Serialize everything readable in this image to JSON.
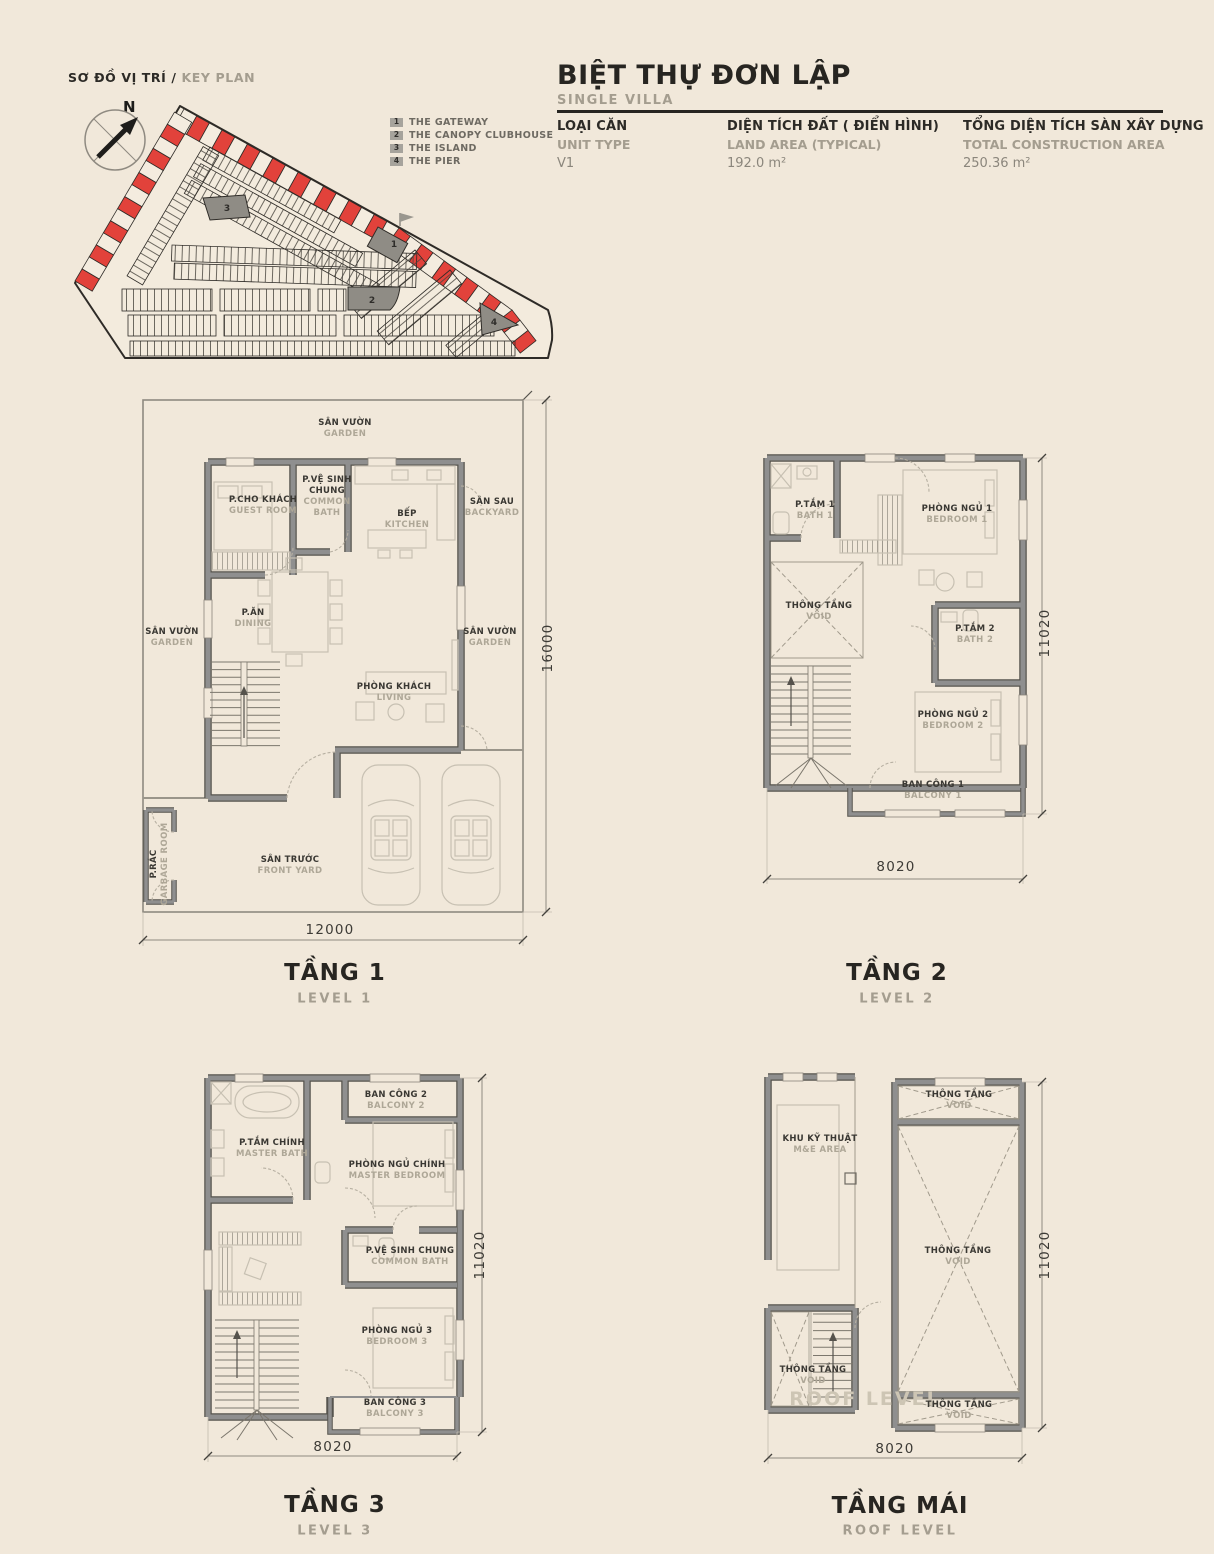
{
  "colors": {
    "background": "#F1E8DA",
    "accent_red": "#E2423B",
    "wall_gray": "#8A8A8A",
    "text_dark": "#2C2A26",
    "text_muted": "#A49D8F"
  },
  "key_plan": {
    "title_vi": "SƠ ĐỒ VỊ TRÍ /",
    "title_en": " KEY PLAN",
    "north_label": "N",
    "legend": [
      {
        "num": "1",
        "label": "THE GATEWAY"
      },
      {
        "num": "2",
        "label": "THE CANOPY CLUBHOUSE"
      },
      {
        "num": "3",
        "label": "THE ISLAND"
      },
      {
        "num": "4",
        "label": "THE PIER"
      }
    ],
    "markers": {
      "m1": "1",
      "m2": "2",
      "m3": "3",
      "m4": "4"
    }
  },
  "header": {
    "title": "BIỆT THỰ ĐƠN LẬP",
    "subtitle": "SINGLE VILLA",
    "specs": [
      {
        "label_vi": "LOẠI CĂN",
        "label_en": "UNIT TYPE",
        "value": "V1"
      },
      {
        "label_vi": "DIỆN TÍCH ĐẤT ( ĐIỂN HÌNH)",
        "label_en": "LAND AREA (TYPICAL)",
        "value": "192.0 m²"
      },
      {
        "label_vi": "TỔNG DIỆN TÍCH SÀN XÂY DỰNG",
        "label_en": "TOTAL CONSTRUCTION AREA",
        "value": "250.36 m²"
      }
    ]
  },
  "levels": {
    "l1": {
      "title": "TẦNG 1",
      "subtitle": "LEVEL 1",
      "dim_width": "12000",
      "dim_height": "16000",
      "rooms": {
        "garden_top": {
          "vi": "SÂN VƯỜN",
          "en": "GARDEN"
        },
        "backyard": {
          "vi": "SÂN SAU",
          "en": "BACKYARD"
        },
        "guest_room": {
          "vi": "P.CHO KHÁCH",
          "en": "GUEST ROOM"
        },
        "common_bath": {
          "vi": "P.VỆ SINH CHUNG",
          "en": "COMMON BATH"
        },
        "kitchen": {
          "vi": "BẾP",
          "en": "KITCHEN"
        },
        "garden_left": {
          "vi": "SÂN VƯỜN",
          "en": "GARDEN"
        },
        "dining": {
          "vi": "P.ĂN",
          "en": "DINING"
        },
        "garden_right": {
          "vi": "SÂN VƯỜN",
          "en": "GARDEN"
        },
        "living": {
          "vi": "PHÒNG KHÁCH",
          "en": "LIVING"
        },
        "front_yard": {
          "vi": "SÂN TRƯỚC",
          "en": "FRONT YARD"
        },
        "garbage": {
          "vi": "P.RÁC",
          "en": "GARBAGE ROOM"
        }
      }
    },
    "l2": {
      "title": "TẦNG 2",
      "subtitle": "LEVEL 2",
      "dim_width": "8020",
      "dim_height": "11020",
      "rooms": {
        "bath1": {
          "vi": "P.TẮM 1",
          "en": "BATH 1"
        },
        "bedroom1": {
          "vi": "PHÒNG NGỦ 1",
          "en": "BEDROOM 1"
        },
        "void": {
          "vi": "THÔNG TẦNG",
          "en": "VOID"
        },
        "bath2": {
          "vi": "P.TẮM 2",
          "en": "BATH 2"
        },
        "bedroom2": {
          "vi": "PHÒNG NGỦ 2",
          "en": "BEDROOM 2"
        },
        "balcony1": {
          "vi": "BAN CÔNG 1",
          "en": "BALCONY 1"
        }
      }
    },
    "l3": {
      "title": "TẦNG 3",
      "subtitle": "LEVEL 3",
      "dim_width": "8020",
      "dim_height": "11020",
      "rooms": {
        "balcony2": {
          "vi": "BAN CÔNG 2",
          "en": "BALCONY 2"
        },
        "master_bath": {
          "vi": "P.TẮM CHÍNH",
          "en": "MASTER BATH"
        },
        "master_bedroom": {
          "vi": "PHÒNG NGỦ CHÍNH",
          "en": "MASTER BEDROOM"
        },
        "common_bath": {
          "vi": "P.VỆ SINH CHUNG",
          "en": "COMMON BATH"
        },
        "bedroom3": {
          "vi": "PHÒNG NGỦ 3",
          "en": "BEDROOM 3"
        },
        "balcony3": {
          "vi": "BAN CÔNG 3",
          "en": "BALCONY 3"
        }
      }
    },
    "roof": {
      "title": "TẦNG MÁI",
      "subtitle": "ROOF LEVEL",
      "dim_width": "8020",
      "dim_height": "11020",
      "watermark": "ROOF LEVEL",
      "rooms": {
        "void_top": {
          "vi": "THÔNG TẦNG",
          "en": "VOID"
        },
        "me_area": {
          "vi": "KHU KỸ THUẬT",
          "en": "M&E AREA"
        },
        "void_center": {
          "vi": "THÔNG TẦNG",
          "en": "VOID"
        },
        "void_stair": {
          "vi": "THÔNG TẦNG",
          "en": "VOID"
        },
        "void_bottom": {
          "vi": "THÔNG TẦNG",
          "en": "VOID"
        }
      }
    }
  }
}
